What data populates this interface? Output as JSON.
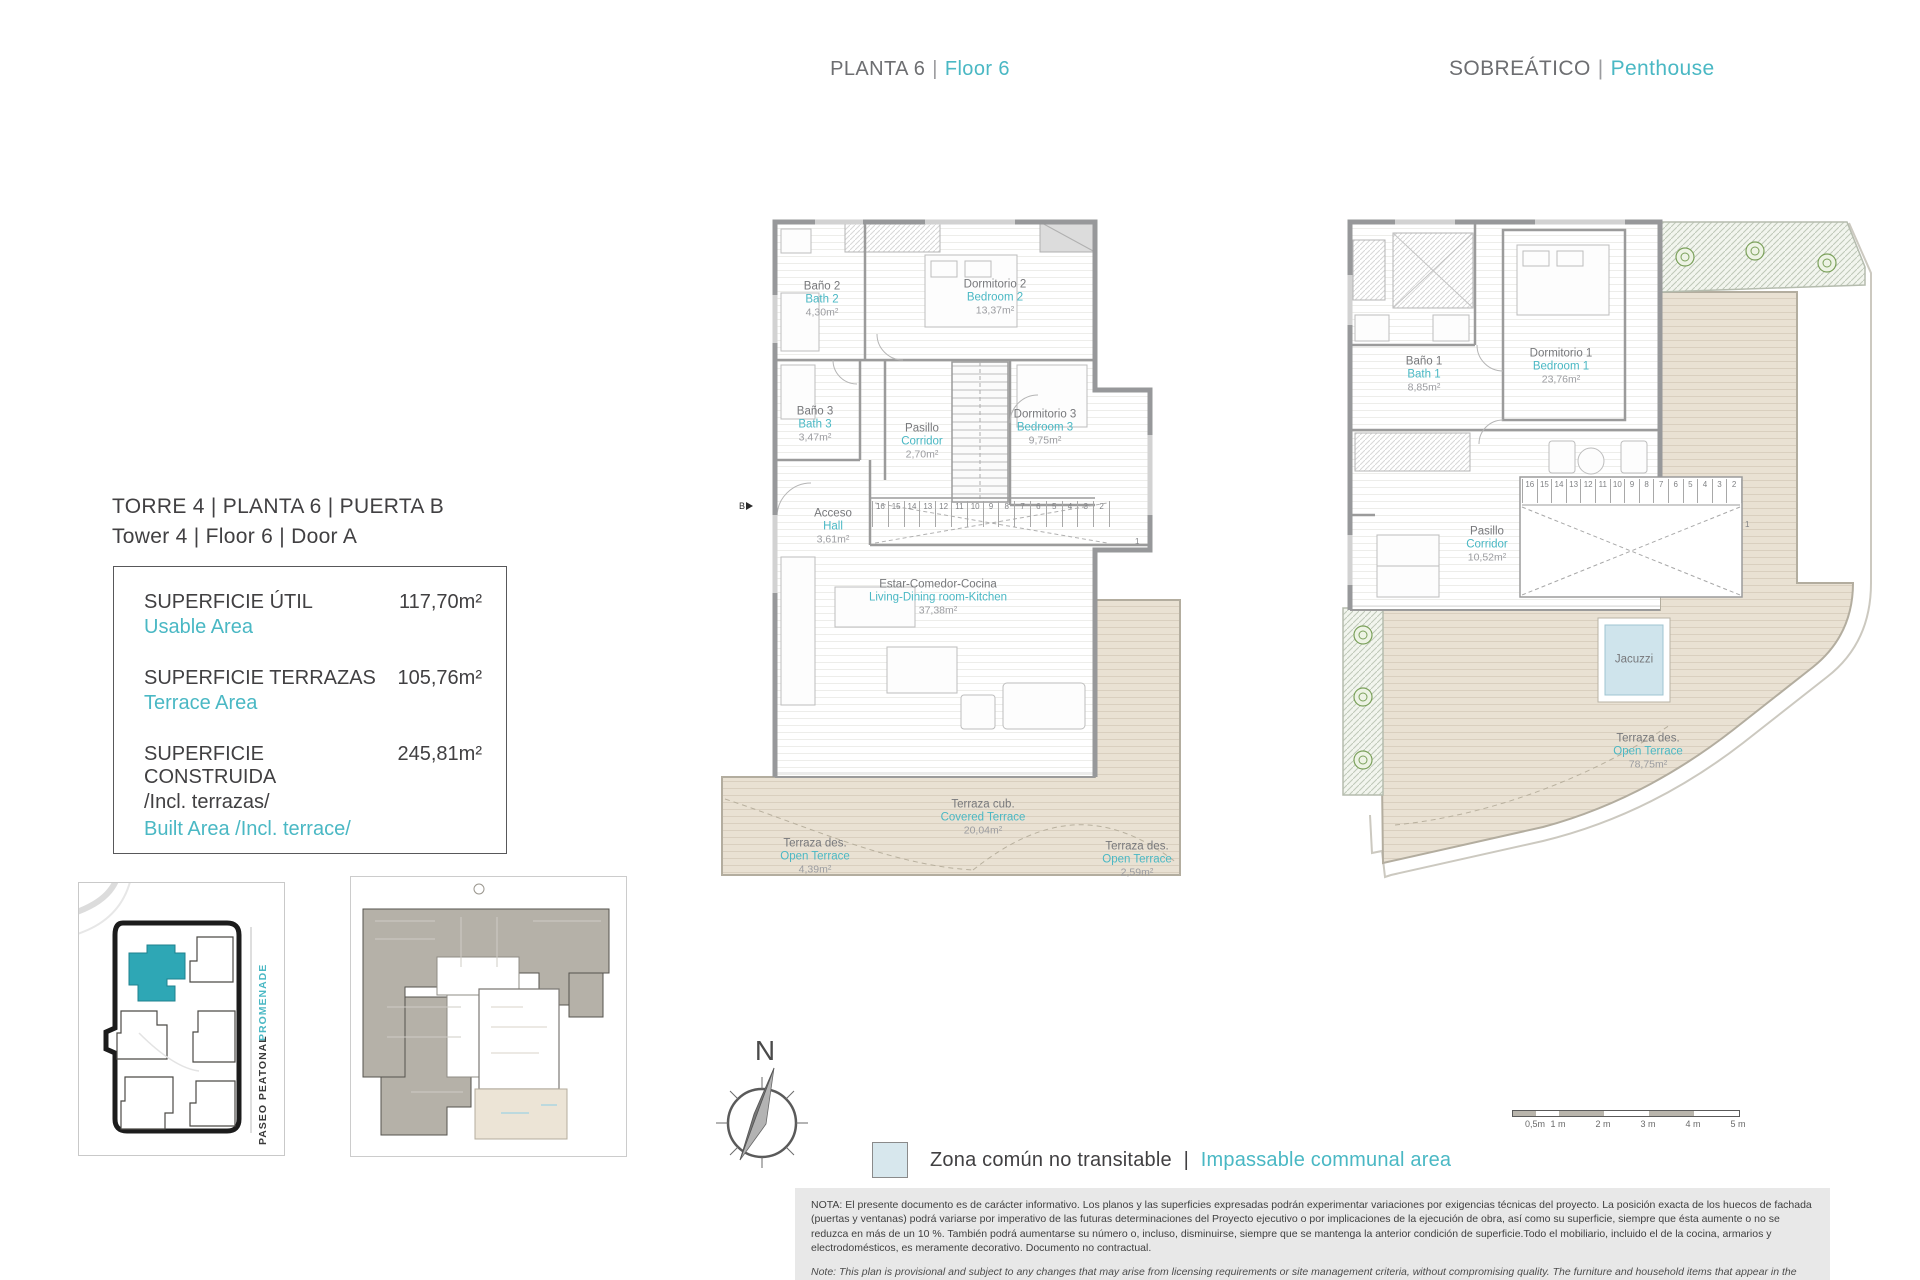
{
  "accent_teal": "#4ab8c4",
  "header": {
    "floor_es": "PLANTA 6",
    "divider": "|",
    "floor_en": "Floor 6",
    "right_es": "SOBREÁTICO",
    "right_en": "Penthouse"
  },
  "unit": {
    "title_es": "TORRE 4 | PLANTA 6 | PUERTA B",
    "title_en": "Tower 4 | Floor 6 | Door A"
  },
  "areas": {
    "rows": [
      {
        "label_es": "SUPERFICIE ÚTIL",
        "label_en": "Usable Area",
        "value": "117,70m²"
      },
      {
        "label_es": "SUPERFICIE TERRAZAS",
        "label_en": "Terrace Area",
        "value": "105,76m²"
      },
      {
        "label_es": "SUPERFICIE CONSTRUIDA",
        "label_es_line2": "/Incl. terrazas/",
        "label_en": "Built Area /Incl. terrace/",
        "value": "245,81m²"
      }
    ]
  },
  "site": {
    "promenade": "PROMENADE",
    "paseo": "PASEO PEATONAL"
  },
  "stairs": {
    "run": [
      "16",
      "15",
      "14",
      "13",
      "12",
      "11",
      "10",
      "9",
      "8",
      "7",
      "6",
      "5",
      "4",
      "3",
      "2"
    ],
    "last": "1"
  },
  "plan6": {
    "entry_marker": "B",
    "rooms": {
      "bath2": {
        "es": "Baño 2",
        "en": "Bath 2",
        "area": "4,30m²"
      },
      "bed2": {
        "es": "Dormitorio 2",
        "en": "Bedroom 2",
        "area": "13,37m²"
      },
      "bath3": {
        "es": "Baño 3",
        "en": "Bath 3",
        "area": "3,47m²"
      },
      "corridor": {
        "es": "Pasillo",
        "en": "Corridor",
        "area": "2,70m²"
      },
      "bed3": {
        "es": "Dormitorio 3",
        "en": "Bedroom 3",
        "area": "9,75m²"
      },
      "hall": {
        "es": "Acceso",
        "en": "Hall",
        "area": "3,61m²"
      },
      "living": {
        "es": "Estar-Comedor-Cocina",
        "en": "Living-Dining room-Kitchen",
        "area": "37,38m²"
      },
      "terrace_open_left": {
        "es": "Terraza des.",
        "en": "Open Terrace",
        "area": "4,39m²"
      },
      "terrace_covered": {
        "es": "Terraza cub.",
        "en": "Covered Terrace",
        "area": "20,04m²"
      },
      "terrace_open_right": {
        "es": "Terraza des.",
        "en": "Open Terrace",
        "area": "2,59m²"
      }
    }
  },
  "penthouse": {
    "rooms": {
      "bath1": {
        "es": "Baño 1",
        "en": "Bath 1",
        "area": "8,85m²"
      },
      "bed1": {
        "es": "Dormitorio 1",
        "en": "Bedroom 1",
        "area": "23,76m²"
      },
      "corridor": {
        "es": "Pasillo",
        "en": "Corridor",
        "area": "10,52m²"
      },
      "jacuzzi": {
        "es": "Jacuzzi"
      },
      "terrace": {
        "es": "Terraza des.",
        "en": "Open Terrace",
        "area": "78,75m²"
      }
    }
  },
  "compass": {
    "north": "N"
  },
  "legend": {
    "es": "Zona común no transitable",
    "divider": "|",
    "en": "Impassable communal area"
  },
  "scale_bar": {
    "labels": [
      "0,5m",
      "1 m",
      "2 m",
      "3 m",
      "4 m",
      "5 m"
    ]
  },
  "notes": {
    "es": "NOTA:  El presente documento es de carácter informativo. Los planos y las superficies expresadas podrán experimentar variaciones por exigencias técnicas del proyecto. La posición exacta de los huecos de fachada (puertas y ventanas) podrá variarse por imperativo de las futuras determinaciones del Proyecto ejecutivo o por implicaciones de la ejecución de obra, así como su superficie, siempre que ésta aumente o no se reduzca en más de un 10 %. También podrá aumentarse su número o, incluso, disminuirse, siempre que se mantenga la anterior condición de superficie.Todo el mobiliario, incluido el de la cocina, armarios y electrodomésticos, es meramente decorativo. Documento no contractual.",
    "en": "Note: This plan is provisional and subject to any changes that may arise from licensing requirements or site management criteria, without compromising quality. The furniture and household items that appear in the plan are merely for decorative purposes. This is a non-contractual document. The imperative determinations of the Executive Project or by implications works of the execution, can change the exact position of the facade of doors and windows, as well the surface area may also be increased or even decrease not more than a 10%.",
    "version": "V.1_ENE-22"
  }
}
